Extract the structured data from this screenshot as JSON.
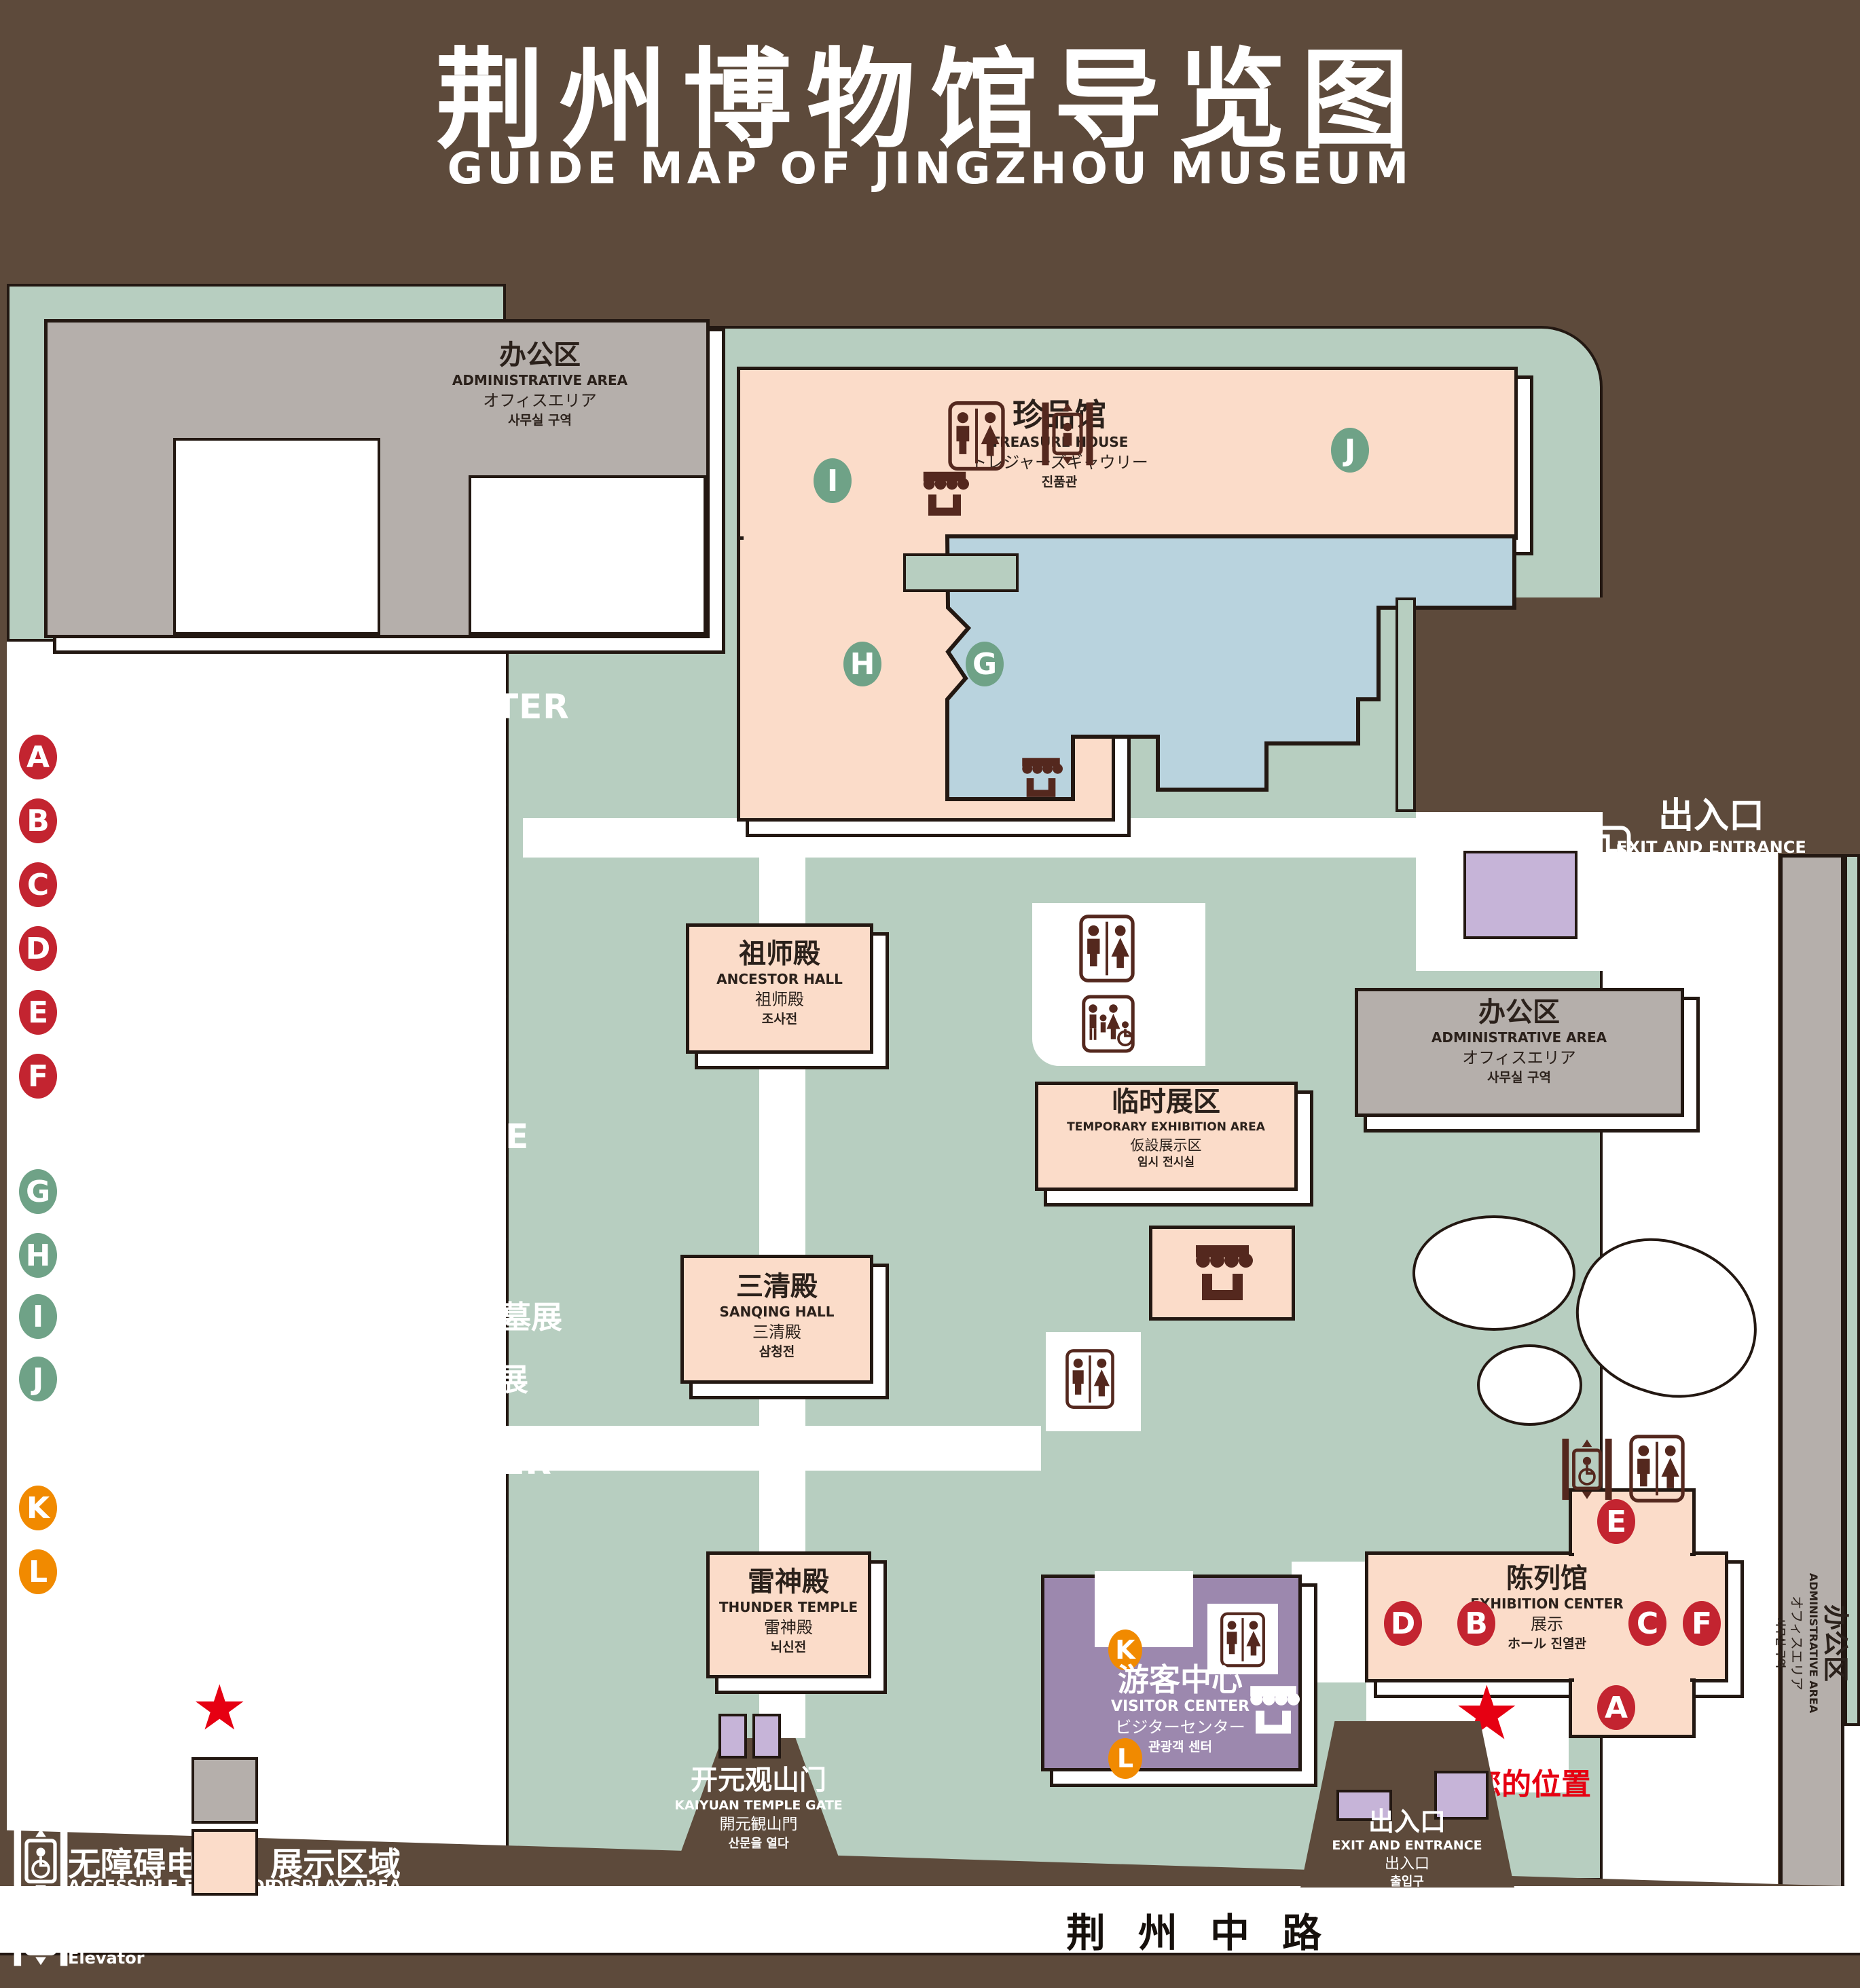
{
  "title": {
    "zh": "荆州博物馆导览图",
    "en": "GUIDE MAP OF JINGZHOU MUSEUM"
  },
  "legend": {
    "sections": [
      {
        "zh": "陈列馆",
        "en": "EXHIBITION CENTER",
        "items": [
          {
            "badge": "A",
            "zh": "《火中的凤凰》壁画",
            "en": "THE PHOENIX IN FIRE \"MURAL PAINTING",
            "floor": "1F"
          },
          {
            "badge": "B",
            "zh": "荆州出土铜器展",
            "en": "JINGZHOU UNEARTHED BRONZE WARE EXHIBITION",
            "floor": "1F"
          },
          {
            "badge": "C",
            "zh": "江汉平原原始文化展",
            "en": "JIANGHAN PLAIN PRIMITIVE CULTURE EXHIBITION",
            "floor": "1F"
          },
          {
            "badge": "D",
            "zh": "荆州出土瓷器展",
            "en": "JINGZHOU UNEARTHED PORCELAIN EXHIBITIONE",
            "floor": "2F"
          },
          {
            "badge": "E",
            "zh": "荆州出土简牍展",
            "en": "JINGZHOU EXCAVATED BAMBOO SLIPS EXHIBITION",
            "floor": "2F"
          },
          {
            "badge": "F",
            "zh": "荆州出土玉器展",
            "en": "JINGZHOU UNEARTHED JADE EXHIBITION",
            "floor": "2F"
          }
        ]
      },
      {
        "zh": "珍品馆",
        "en": "TREASURE HOUSE",
        "items": [
          {
            "badge": "G",
            "zh": "放映厅",
            "en": "PROJECTION HALL",
            "floor": "1F"
          },
          {
            "badge": "H",
            "zh": "互动体验厅",
            "en": "INTERACTIVE EXPERIENCE HALL",
            "floor": "1F"
          },
          {
            "badge": "I",
            "zh": "五大夫遂——凤凰山168号汉墓展",
            "en": "WUDAFU—EXHIBITION OF NO.168 HAN TOMB FROM FENGHUANGSHAN",
            "floor": "2F"
          },
          {
            "badge": "J",
            "zh": "丹漆神韵——楚秦汉漆器精品展",
            "en": "ROMANTIC CHARM OF THE CRIMSON LACQUERS—EXHIBITIONS OF FINE LACQUERS FROM CHU,QIN AND HAN DYNASTIES",
            "floor": "1-2F"
          }
        ]
      },
      {
        "zh": "游客中心",
        "en": "VISITOR CENTER",
        "items": [
          {
            "badge": "K",
            "zh": "安全保卫",
            "en": "SECURITY",
            "floor": "1F"
          },
          {
            "badge": "L",
            "zh": "医疗点",
            "en": "CLINIC",
            "floor": "1F"
          }
        ]
      }
    ],
    "icons_left": [
      {
        "icon": "store-icon",
        "zh": "文创商店",
        "en": "STORE"
      },
      {
        "icon": "restrooms-icon",
        "zh": "卫生间",
        "en": "RESTROOMS"
      },
      {
        "icon": "family-restrooms-icon",
        "zh": "家庭卫生间",
        "en": "FAMILY RESTROOMS"
      },
      {
        "icon": "accessible-elevator-icon",
        "zh": "无障碍电梯",
        "en": "ACCESSIBLE ELEVATOR"
      },
      {
        "icon": "elevator-icon",
        "zh": "电梯",
        "en": "Elevator"
      }
    ],
    "icons_right": [
      {
        "icon": "exit-icon",
        "zh": "出入口",
        "en": "EXIT AND ENTRANCE"
      },
      {
        "icon": "location-star",
        "zh": "您的位置",
        "en": "YOUR LOCATION"
      },
      {
        "icon": "office-swatch",
        "zh": "办公区域",
        "en": "OFFICE AREA"
      },
      {
        "icon": "display-swatch",
        "zh": "展示区域",
        "en": "DISPLAY AREA"
      }
    ]
  },
  "map": {
    "admin": {
      "zh": "办公区",
      "en": "ADMINISTRATIVE AREA",
      "ja": "オフィスエリア",
      "ko": "사무실 구역"
    },
    "treasure": {
      "zh": "珍品馆",
      "en": "TREASURE HOUSE",
      "ja": "トレジャーズギャウリー",
      "ko": "진품관"
    },
    "ancestor": {
      "zh": "祖师殿",
      "en": "ANCESTOR HALL",
      "ja": "祖师殿",
      "ko": "조사전"
    },
    "temporary": {
      "zh": "临时展区",
      "en": "TEMPORARY EXHIBITION AREA",
      "ja": "仮設展示区",
      "ko": "임시 전시실"
    },
    "sanqing": {
      "zh": "三清殿",
      "en": "SANQING HALL",
      "ja": "三清殿",
      "ko": "삼청전"
    },
    "thunder": {
      "zh": "雷神殿",
      "en": "THUNDER TEMPLE",
      "ja": "雷神殿",
      "ko": "뇌신전"
    },
    "visitor": {
      "zh": "游客中心",
      "en": "VISITOR CENTER",
      "ja": "ビジターセンター",
      "ko": "관광객 센터"
    },
    "exhibition": {
      "zh": "陈列馆",
      "en": "EXHIBITION CENTER",
      "ja": "展示",
      "ko": "ホール 진열관"
    },
    "exit": {
      "zh": "出入口",
      "en": "EXIT AND ENTRANCE",
      "ja": "出入口",
      "ko": "출입구"
    },
    "gate": {
      "zh": "开元观山门",
      "en": "KAIYUAN TEMPLE GATE",
      "ja": "開元観山門",
      "ko": "산문을 열다"
    },
    "road_name": "荆州中路",
    "your_location": "您的位置",
    "star": "★",
    "letters": {
      "A": "A",
      "B": "B",
      "C": "C",
      "D": "D",
      "E": "E",
      "F": "F",
      "G": "G",
      "H": "H",
      "I": "I",
      "J": "J",
      "K": "K",
      "L": "L"
    }
  },
  "colors": {
    "background": "#5d4a3b",
    "campus_green": "#b7cec0",
    "display_area": "#fbdcc9",
    "office_area": "#b5afab",
    "pond": "#b9d3de",
    "visitor_purple": "#9c88ae",
    "entrance_purple": "#c6b4d8",
    "badge_red": "#c32430",
    "badge_green": "#6fa287",
    "badge_orange": "#f18a00",
    "location_red": "#e60012",
    "icon_brown": "#54281e"
  }
}
